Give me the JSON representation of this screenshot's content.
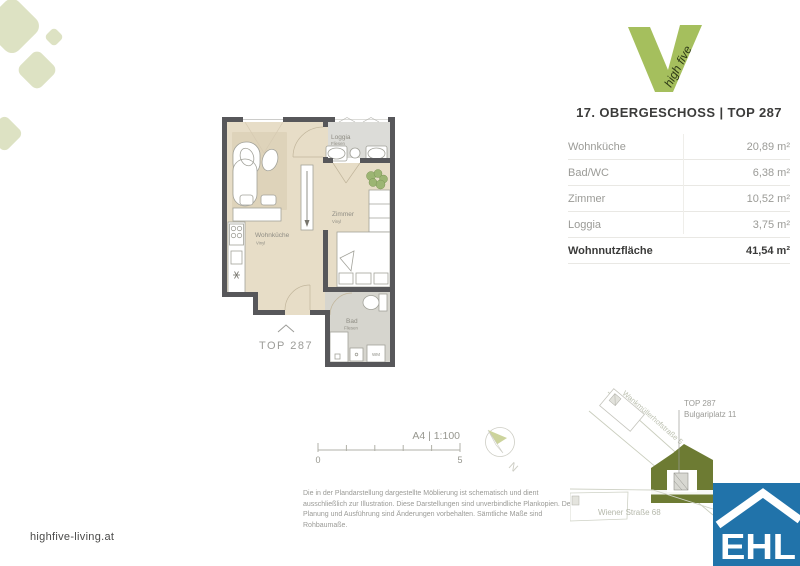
{
  "page": {
    "website": "highfive-living.at"
  },
  "logo": {
    "brand": "high five"
  },
  "header": {
    "title": "17. OBERGESCHOSS | TOP 287"
  },
  "area_table": {
    "rows": [
      {
        "label": "Wohnküche",
        "value": "20,89 m²"
      },
      {
        "label": "Bad/WC",
        "value": "6,38 m²"
      },
      {
        "label": "Zimmer",
        "value": "10,52 m²"
      },
      {
        "label": "Loggia",
        "value": "3,75 m²"
      }
    ],
    "total": {
      "label": "Wohnnutzfläche",
      "value": "41,54 m²"
    }
  },
  "floorplan": {
    "unit_label": "TOP 287",
    "rooms": {
      "wohnkueche": {
        "name": "Wohnküche",
        "floor": "Vinyl"
      },
      "zimmer": {
        "name": "Zimmer",
        "floor": "Vinyl"
      },
      "loggia": {
        "name": "Loggia",
        "floor": "Fliesen"
      },
      "bad": {
        "name": "Bad",
        "floor": "Fliesen"
      }
    },
    "washing_machine_label": "WM"
  },
  "scalebar": {
    "label": "A4 | 1:100",
    "tick_start": "0",
    "tick_end": "5"
  },
  "north_label": "N",
  "sitemap": {
    "street_diagonal": "Wankmüllerhofstraße 5",
    "street_bottom": "Wiener Straße 68",
    "callout_line1": "TOP 287",
    "callout_line2": "Bulgariplatz 11"
  },
  "ehl_logo_text": "EHL",
  "disclaimer": "Die in der Plandarstellung dargestellte Möblierung ist schematisch und dient ausschließlich zur Illustration. Diese Darstellungen sind unverbindliche Plankopien. Der Planung und Ausführung sind Änderungen vorbehalten. Sämtliche Maße sind Rohbaumaße.",
  "colors": {
    "accent_green": "#a5bf5d",
    "sage": "#dde2c3",
    "olive": "#6d7b33",
    "ehl_blue": "#2173aa",
    "wall": "#57575a"
  }
}
